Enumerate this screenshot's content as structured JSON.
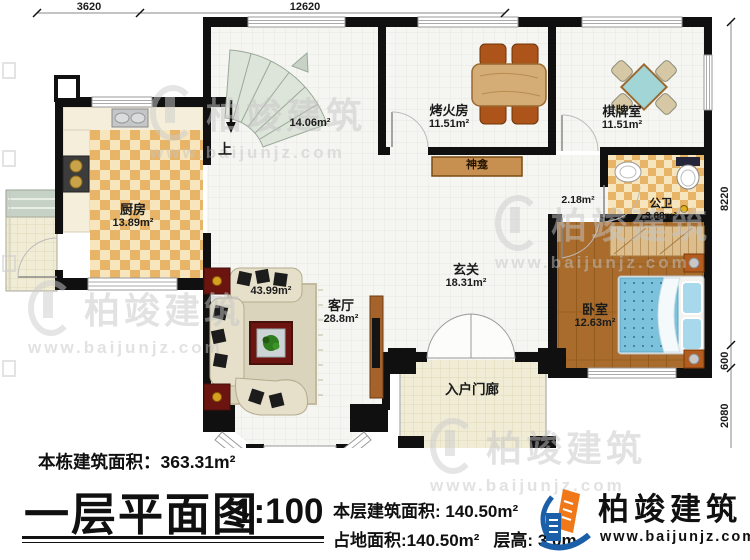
{
  "dimensions": {
    "top_left": "3620",
    "top_span": "12620",
    "right_height": "8220",
    "right_step": "600",
    "right_porch": "2080"
  },
  "stair": {
    "area": "14.06m²",
    "up_label": "上"
  },
  "rooms": {
    "kitchen": {
      "name": "厨房",
      "area": "13.89m²"
    },
    "fire_room": {
      "name": "烤火房",
      "area": "11.51m²"
    },
    "chess_room": {
      "name": "棋牌室",
      "area": "11.51m²"
    },
    "shrine": {
      "label": "神龛"
    },
    "bathroom": {
      "name": "公卫",
      "area": "3.68m²"
    },
    "passage": {
      "area": "2.18m²"
    },
    "foyer": {
      "name": "玄关",
      "area": "18.31m²"
    },
    "living_room": {
      "name": "客厅",
      "area": "28.8m²",
      "partial_area": "43.99m²"
    },
    "bedroom": {
      "name": "卧室",
      "area": "12.63m²"
    },
    "entry_porch": {
      "name": "入户门廊"
    }
  },
  "footer": {
    "total_area": "本栋建筑面积：363.31m²",
    "title": "一层平面图",
    "scale": "1:100",
    "floor_area": "本层建筑面积: 140.50m²",
    "ground_area": "占地面积:140.50m²",
    "floor_height": "层高: 3.0m",
    "brand": "柏竣建筑",
    "website": "www.baijunjz.com"
  },
  "watermark": {
    "brand": "柏竣建筑",
    "website": "www.baijunjz.com"
  },
  "colors": {
    "wall": "#101010",
    "kitchen_tile": "#e9ba70",
    "wood_floor": "#a96c2c",
    "bed_blue": "#7cc2dc",
    "brand_blue": "#1a5fa8",
    "brand_orange": "#f07818"
  }
}
